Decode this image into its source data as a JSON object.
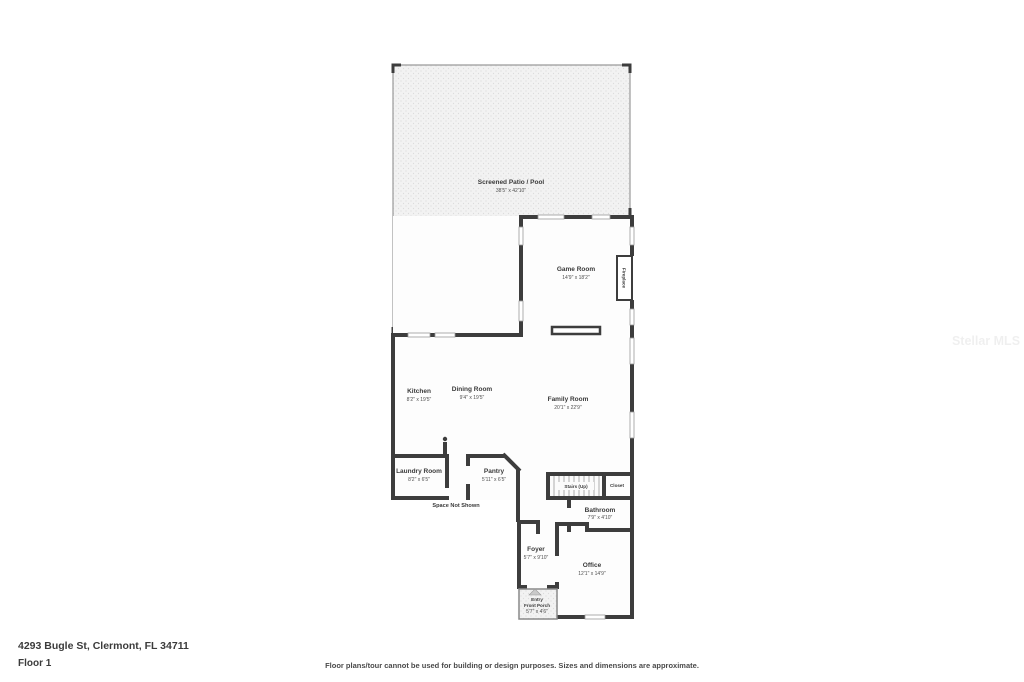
{
  "meta": {
    "address": "4293 Bugle St, Clermont, FL 34711",
    "floor_label": "Floor 1",
    "disclaimer": "Floor plans/tour cannot be used for building or design purposes. Sizes and dimensions are approximate.",
    "watermark": "Stellar MLS"
  },
  "annotations": {
    "space_not_shown": "Space Not Shown"
  },
  "rooms": {
    "screened_patio": {
      "name": "Screened Patio / Pool",
      "dims": "38'5\" x 42'10\""
    },
    "game_room": {
      "name": "Game Room",
      "dims": "14'9\" x 18'2\""
    },
    "fireplace": {
      "name": "Fireplace"
    },
    "kitchen": {
      "name": "Kitchen",
      "dims": "8'2\" x 19'5\""
    },
    "dining_room": {
      "name": "Dining Room",
      "dims": "9'4\" x 19'5\""
    },
    "family_room": {
      "name": "Family Room",
      "dims": "20'1\" x 22'9\""
    },
    "laundry_room": {
      "name": "Laundry Room",
      "dims": "8'2\" x 6'5\""
    },
    "pantry": {
      "name": "Pantry",
      "dims": "5'11\" x 6'5\""
    },
    "stairs": {
      "name": "Stairs (Up)"
    },
    "closet": {
      "name": "Closet"
    },
    "bathroom": {
      "name": "Bathroom",
      "dims": "7'9\" x 4'10\""
    },
    "foyer": {
      "name": "Foyer",
      "dims": "5'7\" x 9'10\""
    },
    "office": {
      "name": "Office",
      "dims": "12'1\" x 14'9\""
    },
    "entry_porch": {
      "name_line1": "Entry",
      "name_line2": "Front Porch",
      "dims": "5'7\" x 4'6\""
    }
  },
  "colors": {
    "wall": "#3d3d3d",
    "screen_wall": "#9a9a9a",
    "patio_fill": "#f2f2f2",
    "background": "#ffffff",
    "label_text": "#3a3a3a"
  }
}
